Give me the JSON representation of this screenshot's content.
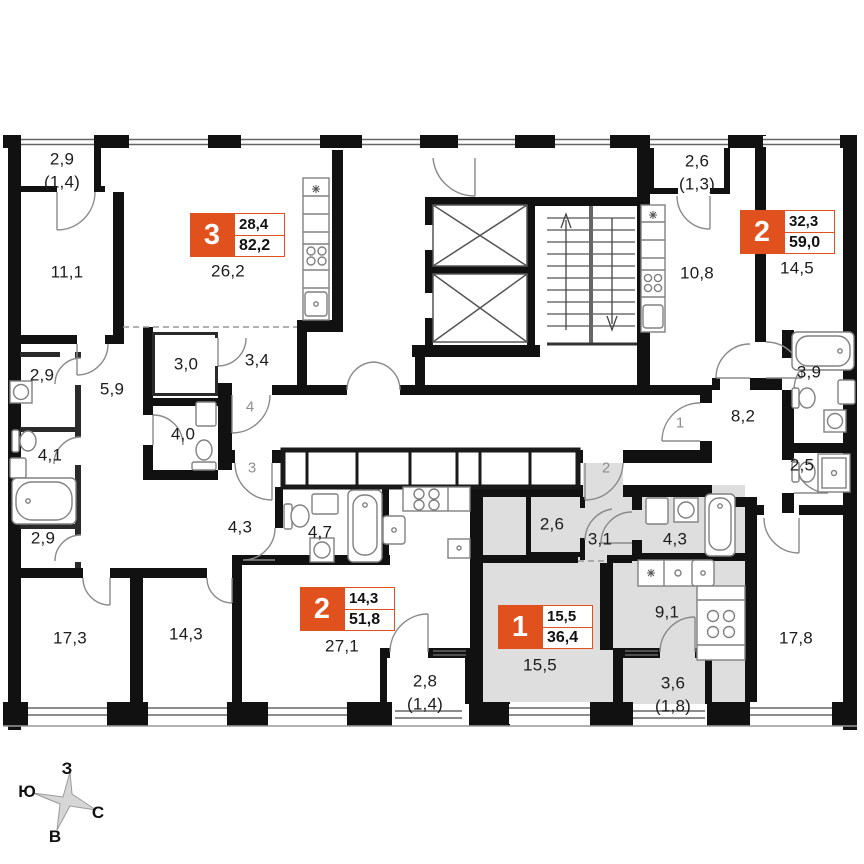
{
  "plan": {
    "accent_color": "#E0511E",
    "highlight_fill": "#DEDEDE"
  },
  "apartments": [
    {
      "number": "3",
      "living_area": "28,4",
      "total_area": "82,2",
      "x": 190,
      "y": 213
    },
    {
      "number": "2",
      "living_area": "32,3",
      "total_area": "59,0",
      "x": 740,
      "y": 210
    },
    {
      "number": "2",
      "living_area": "14,3",
      "total_area": "51,8",
      "x": 300,
      "y": 587
    },
    {
      "number": "1",
      "living_area": "15,5",
      "total_area": "36,4",
      "x": 498,
      "y": 605
    }
  ],
  "room_labels": [
    {
      "text": "2,9",
      "x": 62,
      "y": 159
    },
    {
      "text": "(1,4)",
      "x": 62,
      "y": 182
    },
    {
      "text": "11,1",
      "x": 67,
      "y": 272
    },
    {
      "text": "26,2",
      "x": 228,
      "y": 271
    },
    {
      "text": "2,6",
      "x": 697,
      "y": 161
    },
    {
      "text": "(1,3)",
      "x": 697,
      "y": 184
    },
    {
      "text": "10,8",
      "x": 697,
      "y": 273
    },
    {
      "text": "14,5",
      "x": 797,
      "y": 268
    },
    {
      "text": "2,9",
      "x": 42,
      "y": 375
    },
    {
      "text": "5,9",
      "x": 112,
      "y": 389
    },
    {
      "text": "3,0",
      "x": 186,
      "y": 364
    },
    {
      "text": "3,4",
      "x": 257,
      "y": 360
    },
    {
      "text": "4,0",
      "x": 183,
      "y": 434
    },
    {
      "text": "4,1",
      "x": 50,
      "y": 455
    },
    {
      "text": "2,9",
      "x": 43,
      "y": 538
    },
    {
      "text": "3,9",
      "x": 809,
      "y": 372
    },
    {
      "text": "8,2",
      "x": 743,
      "y": 416
    },
    {
      "text": "2,5",
      "x": 802,
      "y": 465
    },
    {
      "text": "4,3",
      "x": 240,
      "y": 527
    },
    {
      "text": "4,7",
      "x": 320,
      "y": 532
    },
    {
      "text": "2,6",
      "x": 552,
      "y": 524
    },
    {
      "text": "3,1",
      "x": 600,
      "y": 539
    },
    {
      "text": "4,3",
      "x": 675,
      "y": 539
    },
    {
      "text": "9,1",
      "x": 667,
      "y": 612
    },
    {
      "text": "17,3",
      "x": 70,
      "y": 638
    },
    {
      "text": "14,3",
      "x": 186,
      "y": 634
    },
    {
      "text": "27,1",
      "x": 342,
      "y": 646
    },
    {
      "text": "15,5",
      "x": 540,
      "y": 665
    },
    {
      "text": "17,8",
      "x": 796,
      "y": 638
    },
    {
      "text": "2,8",
      "x": 425,
      "y": 681
    },
    {
      "text": "(1,4)",
      "x": 425,
      "y": 704
    },
    {
      "text": "3,6",
      "x": 673,
      "y": 683
    },
    {
      "text": "(1,8)",
      "x": 673,
      "y": 706
    }
  ],
  "unit_doors": [
    {
      "label": "4",
      "x": 250,
      "y": 407
    },
    {
      "label": "3",
      "x": 252,
      "y": 468
    },
    {
      "label": "1",
      "x": 680,
      "y": 423
    },
    {
      "label": "2",
      "x": 606,
      "y": 468
    }
  ],
  "compass": {
    "west": "З",
    "south": "Ю",
    "north": "С",
    "east": "В"
  }
}
